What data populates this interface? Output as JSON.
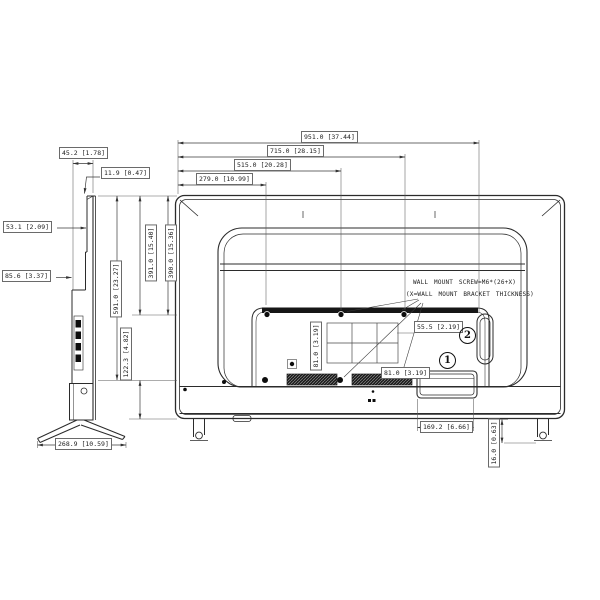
{
  "drawing_type": "tv-rear-and-side-dimension-diagram",
  "dims": {
    "w951": "951.0 [37.44]",
    "w715": "715.0 [28.15]",
    "w515": "515.0 [20.28]",
    "w279": "279.0 [10.99]",
    "d45": "45.2 [1.78]",
    "t11": "11.9 [0.47]",
    "d53": "53.1 [2.09]",
    "d85": "85.6 [3.37]",
    "h591": "591.0 [23.27]",
    "h391": "391.0 [15.40]",
    "h390": "390.0 [15.36]",
    "h122": "122.3 [4.82]",
    "stand_width": "268.9 [10.59]",
    "vesa_v": "81.0 [3.19]",
    "vesa_h": "81.0 [3.19]",
    "off55": "55.5 [2.19]",
    "terminal_width": "169.2 [6.66]",
    "foot16": "16.0 [0.63]"
  },
  "notes": {
    "wall_mount_line1": "WALL MOUNT SCREW=M6*(26+X)",
    "wall_mount_line2": "(X=WALL MOUNT BRACKET THICKNESS)"
  },
  "callouts": {
    "one": "1",
    "two": "2"
  },
  "colors": {
    "line": "#2b2b2b",
    "dimline": "#4a4a4a",
    "fill_dark": "#141414"
  }
}
